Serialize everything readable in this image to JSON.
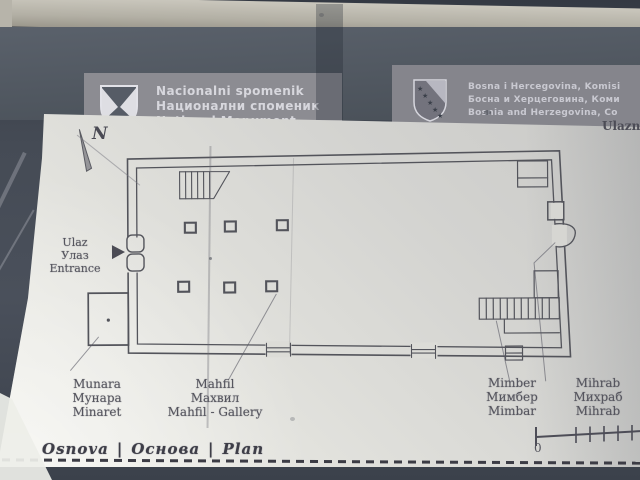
{
  "header": {
    "left": {
      "icon": "commission-shield-icon",
      "line1": "Nacionalni spomenik",
      "line2": "Национални споменик",
      "line3": "National Monument"
    },
    "right": {
      "icon": "bih-coat-of-arms-icon",
      "line1": "Bosna i Hercegovina, Komisi",
      "line2": "Босна и Херцеговина, Коми",
      "line3": "Bosnia and Herzegovina, Co"
    }
  },
  "plan": {
    "compass": "N",
    "edge_note": "Ulazn",
    "entrance": {
      "bs": "Ulaz",
      "cy": "Улаз",
      "en": "Entrance"
    },
    "labels": [
      {
        "bs": "Munara",
        "cy": "Мунара",
        "en": "Minaret"
      },
      {
        "bs": "Mahfil",
        "cy": "Махвил",
        "en": "Mahfil - Gallery"
      },
      {
        "bs": "Mimber",
        "cy": "Мимбер",
        "en": "Mimbar"
      },
      {
        "bs": "Mihrab",
        "cy": "Михраб",
        "en": "Mihrab"
      }
    ],
    "caption": {
      "bs": "Osnova",
      "sep": "|",
      "cy": "Основа",
      "en": "Plan"
    },
    "scale": {
      "zero": "0"
    }
  },
  "colors": {
    "header_band": "#4f5560",
    "header_block": "#8c8c92",
    "panel": "#e3e3de",
    "plan_line": "#53545b",
    "frame": "#b3b0a5"
  }
}
